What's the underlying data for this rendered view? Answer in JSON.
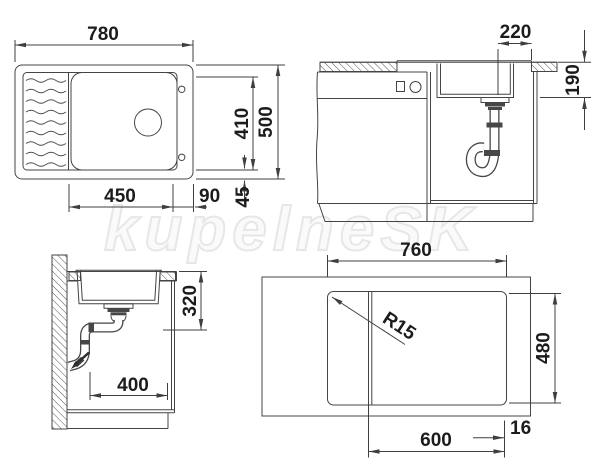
{
  "watermark": "kupelneSK",
  "drawing": {
    "plan_view": {
      "width": "780",
      "depth": "500",
      "bowl_width": "450",
      "bowl_depth": "410",
      "rim_right": "90",
      "rim_front": "45"
    },
    "front_section": {
      "drain_to_edge": "220",
      "bowl_height": "190"
    },
    "side_section": {
      "drain_height": "320",
      "drain_to_front": "400"
    },
    "cutout_view": {
      "cutout_width": "760",
      "cutout_depth": "480",
      "cabinet_width": "600",
      "edge_offset": "16",
      "corner_radius": "R15"
    }
  },
  "colors": {
    "line": "#444444",
    "text": "#1c1c1c",
    "watermark": "#e7e7e7"
  }
}
